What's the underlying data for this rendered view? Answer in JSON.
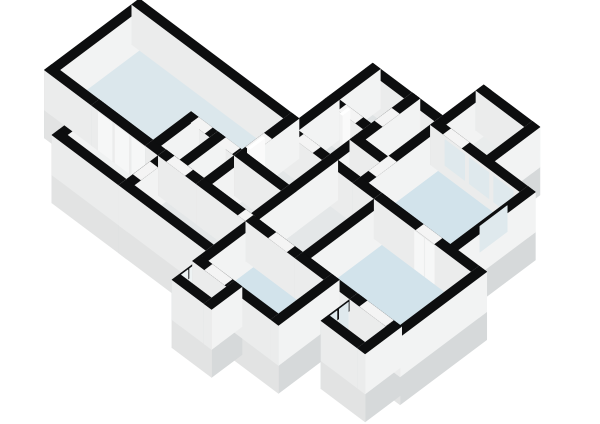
{
  "scene": {
    "name": "3d-floorplan-render",
    "background": "#ffffff",
    "canvas": {
      "width": 600,
      "height": 424
    }
  },
  "floorplan": {
    "projection": {
      "kx": 0.76,
      "ky": 0.57,
      "ox": 52,
      "oy": 70,
      "wall_height": 40,
      "slab_depth": 28,
      "wall_half": 5
    },
    "colors": {
      "wall_top": "#0d0e0f",
      "wall_face_south": "#ebecec",
      "wall_face_west": "#d4d7d8",
      "wall_face_east": "#f2f3f3",
      "slab_south": "#e2e3e3",
      "slab_west": "#c9cdcf",
      "slab_east": "#d6d9da",
      "opening": "#f4f4f4",
      "teal": "#1b9ab4",
      "panel": "#f6f7f7",
      "glass": "#dfe9ed",
      "glass_light": "#eef3f4",
      "box_top": "#ffffff",
      "box_south": "#f2f2f2",
      "box_west": "#dfe1e1",
      "box_east": "#fafafa",
      "floors": {
        "blue_a": "#dbe7ec",
        "blue": "#d2e3eb",
        "pale": "#f0f2f2",
        "pale_blue": "#e4edf1",
        "grey": "#e4e7e8",
        "grey_dark": "#dfe3e4",
        "grey_light": "#e9ecec"
      }
    },
    "rooms": [
      {
        "id": "great-room",
        "rect": [
          0,
          0,
          200,
          115
        ],
        "floor": "blue_a"
      },
      {
        "id": "wing-room",
        "rect": [
          62,
          -52,
          150,
          0
        ],
        "floor": "pale"
      },
      {
        "id": "closet-a",
        "rect": [
          133,
          0,
          168,
          50
        ],
        "floor": "grey"
      },
      {
        "id": "closet-b",
        "rect": [
          168,
          0,
          200,
          50
        ],
        "floor": "grey"
      },
      {
        "id": "closet-c",
        "rect": [
          200,
          0,
          262,
          50
        ],
        "floor": "grey"
      },
      {
        "id": "hall-south",
        "rect": [
          150,
          -52,
          265,
          0
        ],
        "floor": "grey"
      },
      {
        "id": "hall-center",
        "rect": [
          262,
          0,
          330,
          104
        ],
        "floor": "grey"
      },
      {
        "id": "hall-north",
        "rect": [
          200,
          50,
          262,
          104
        ],
        "floor": "grey"
      },
      {
        "id": "bath-a",
        "rect": [
          210,
          104,
          262,
          158
        ],
        "floor": "grey_dark"
      },
      {
        "id": "bath-b",
        "rect": [
          210,
          158,
          262,
          212
        ],
        "floor": "grey_dark"
      },
      {
        "id": "wc",
        "rect": [
          262,
          140,
          302,
          212
        ],
        "floor": "grey_dark"
      },
      {
        "id": "storage",
        "rect": [
          262,
          104,
          302,
          140
        ],
        "floor": "grey"
      },
      {
        "id": "bedroom-east",
        "rect": [
          302,
          104,
          420,
          206
        ],
        "floor": "blue"
      },
      {
        "id": "office-right",
        "rect": [
          302,
          206,
          366,
          266
        ],
        "floor": "grey_light"
      },
      {
        "id": "living-south",
        "rect": [
          265,
          -70,
          368,
          0
        ],
        "floor": "blue"
      },
      {
        "id": "garden-room",
        "rect": [
          268,
          -100,
          310,
          -70
        ],
        "floor": "pale_blue"
      },
      {
        "id": "family-room",
        "rect": [
          330,
          0,
          458,
          104
        ],
        "floor": "blue"
      },
      {
        "id": "entry",
        "rect": [
          402,
          -38,
          450,
          0
        ],
        "floor": "pale_blue"
      }
    ],
    "floor_patches": [
      {
        "id": "shower-floor",
        "rect": [
          238,
          190,
          257,
          207
        ],
        "color": "teal",
        "v": 52
      }
    ],
    "openings": [
      {
        "id": "door-wing",
        "rect": [
          145,
          -38,
          155,
          -16
        ],
        "v": 177
      },
      {
        "id": "door-great-hall",
        "rect": [
          156,
          -5,
          180,
          5
        ],
        "v": 208
      },
      {
        "id": "door-closet-a",
        "rect": [
          138,
          45,
          156,
          55
        ],
        "v": 144
      },
      {
        "id": "door-closet-b",
        "rect": [
          174,
          45,
          192,
          55
        ],
        "v": 145
      },
      {
        "id": "door-great-east",
        "rect": [
          195,
          60,
          205,
          84
        ],
        "v": 143.2
      },
      {
        "id": "door-bath-a",
        "rect": [
          222,
          99,
          244,
          109
        ],
        "v": 133
      },
      {
        "id": "door-bath-b",
        "rect": [
          224,
          153,
          246,
          163
        ],
        "v": 79
      },
      {
        "id": "door-wc",
        "rect": [
          257,
          168,
          267,
          190
        ],
        "v": 132.5
      },
      {
        "id": "door-bedroom-east",
        "rect": [
          297,
          120,
          307,
          146
        ],
        "v": 181
      },
      {
        "id": "door-office",
        "rect": [
          314,
          201,
          338,
          211
        ],
        "v": 156.5
      },
      {
        "id": "door-family",
        "rect": [
          380,
          99,
          404,
          109
        ],
        "v": 291
      },
      {
        "id": "door-living",
        "rect": [
          290,
          -5,
          314,
          5
        ],
        "v": 317
      },
      {
        "id": "door-garden",
        "rect": [
          276,
          -75,
          302,
          -65
        ],
        "v": 387
      },
      {
        "id": "door-entry",
        "rect": [
          410,
          -5,
          444,
          5
        ],
        "v": 427
      },
      {
        "id": "door-halls",
        "rect": [
          250,
          -5,
          262,
          5
        ],
        "v": 301
      }
    ],
    "panels": [
      {
        "id": "wardrobe-panel",
        "axis": "y",
        "plane": -5,
        "a1": 66,
        "a2": 84,
        "z1": 0,
        "z2": 38,
        "color": "panel",
        "v": 112
      },
      {
        "id": "wardrobe-panel",
        "axis": "y",
        "plane": -5,
        "a1": 88,
        "a2": 106,
        "z1": 0,
        "z2": 38,
        "color": "panel",
        "v": 112.1
      },
      {
        "id": "wardrobe-panel",
        "axis": "y",
        "plane": -5,
        "a1": 110,
        "a2": 127,
        "z1": 0,
        "z2": 38,
        "color": "panel",
        "v": 112.2
      },
      {
        "id": "garden-glass-door",
        "axis": "x",
        "plane": 263,
        "a1": -96,
        "a2": -84,
        "z1": 2,
        "z2": 38,
        "color": "glass_light",
        "v": 354
      },
      {
        "id": "garden-glass-door",
        "axis": "x",
        "plane": 263,
        "a1": -82,
        "a2": -72,
        "z1": 2,
        "z2": 38,
        "color": "glass_light",
        "v": 354.1
      },
      {
        "id": "entry-glass-door",
        "axis": "x",
        "plane": 397,
        "a1": -34,
        "a2": -22,
        "z1": 2,
        "z2": 38,
        "color": "glass",
        "v": 422
      },
      {
        "id": "entry-glass-door",
        "axis": "x",
        "plane": 397,
        "a1": -19,
        "a2": -7,
        "z1": 2,
        "z2": 38,
        "color": "glass",
        "v": 422.1
      },
      {
        "id": "window-bedroom",
        "axis": "y",
        "plane": 201,
        "a1": 316,
        "a2": 342,
        "z1": 10,
        "z2": 36,
        "color": "glass",
        "v": 156.2
      },
      {
        "id": "window-bedroom",
        "axis": "y",
        "plane": 201,
        "a1": 348,
        "a2": 374,
        "z1": 10,
        "z2": 36,
        "color": "glass",
        "v": 156.25
      },
      {
        "id": "window-bedroom",
        "axis": "y",
        "plane": 201,
        "a1": 380,
        "a2": 406,
        "z1": 10,
        "z2": 36,
        "color": "glass",
        "v": 156.3
      },
      {
        "id": "window-bedroom-e",
        "axis": "x",
        "plane": 415,
        "a1": 148,
        "a2": 184,
        "z1": 10,
        "z2": 36,
        "color": "glass",
        "v": 266
      },
      {
        "id": "family-double-door",
        "axis": "y",
        "plane": 99,
        "a1": 378,
        "a2": 390,
        "z1": 0,
        "z2": 38,
        "color": "panel",
        "v": 291.5
      },
      {
        "id": "family-double-door",
        "axis": "y",
        "plane": 99,
        "a1": 392,
        "a2": 404,
        "z1": 0,
        "z2": 38,
        "color": "panel",
        "v": 291.6
      }
    ],
    "fixtures": [
      {
        "id": "counter",
        "rect": [
          104,
          4,
          130,
          16
        ],
        "h": 22,
        "v": 105.2
      },
      {
        "id": "toilet",
        "rect": [
          266,
          144,
          278,
          156
        ],
        "h": 13,
        "v": 122.4
      },
      {
        "id": "door-leaf-bath",
        "rect": [
          226,
          153,
          229,
          163
        ],
        "h": 38,
        "v": 80
      },
      {
        "id": "door-leaf-great",
        "rect": [
          195,
          62,
          198,
          82
        ],
        "h": 38,
        "v": 143.6
      }
    ]
  }
}
